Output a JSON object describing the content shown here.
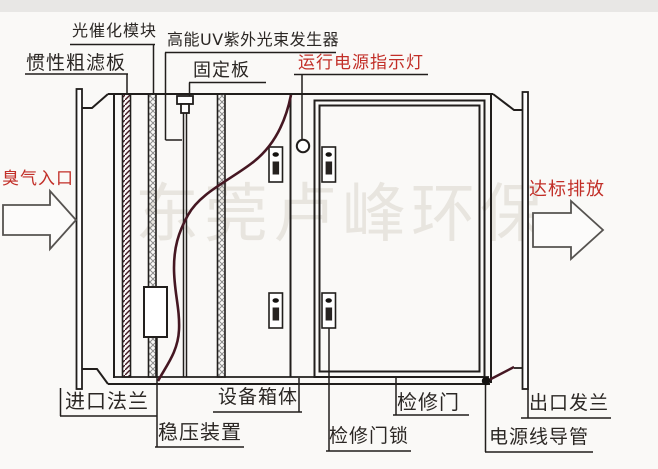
{
  "diagram_title": "UV光解废气净化设备结构图",
  "colors": {
    "background": "#faf9f7",
    "top_band": "#e8e7e5",
    "line": "#211e1c",
    "label_text": "#2b2724",
    "red_label_text": "#c22f28",
    "cable_maroon": "#451722",
    "arrow_outline": "#565350",
    "arrow_fill": "#fcfbfa"
  },
  "labels": {
    "photocatalyst_module": "光催化模块",
    "uv_generator": "高能UV紫外光束发生器",
    "inertial_filter": "惯性粗滤板",
    "fixing_plate": "固定板",
    "power_indicator": "运行电源指示灯",
    "odor_inlet": "臭气入口",
    "compliant_discharge": "达标排放",
    "inlet_flange": "进口法兰",
    "stabilizer": "稳压装置",
    "equipment_cabinet": "设备箱体",
    "access_door": "检修门",
    "access_door_lock": "检修门锁",
    "outlet_flange": "出口发兰",
    "power_conduit": "电源线导管",
    "watermark": "东莞卢峰环保"
  }
}
